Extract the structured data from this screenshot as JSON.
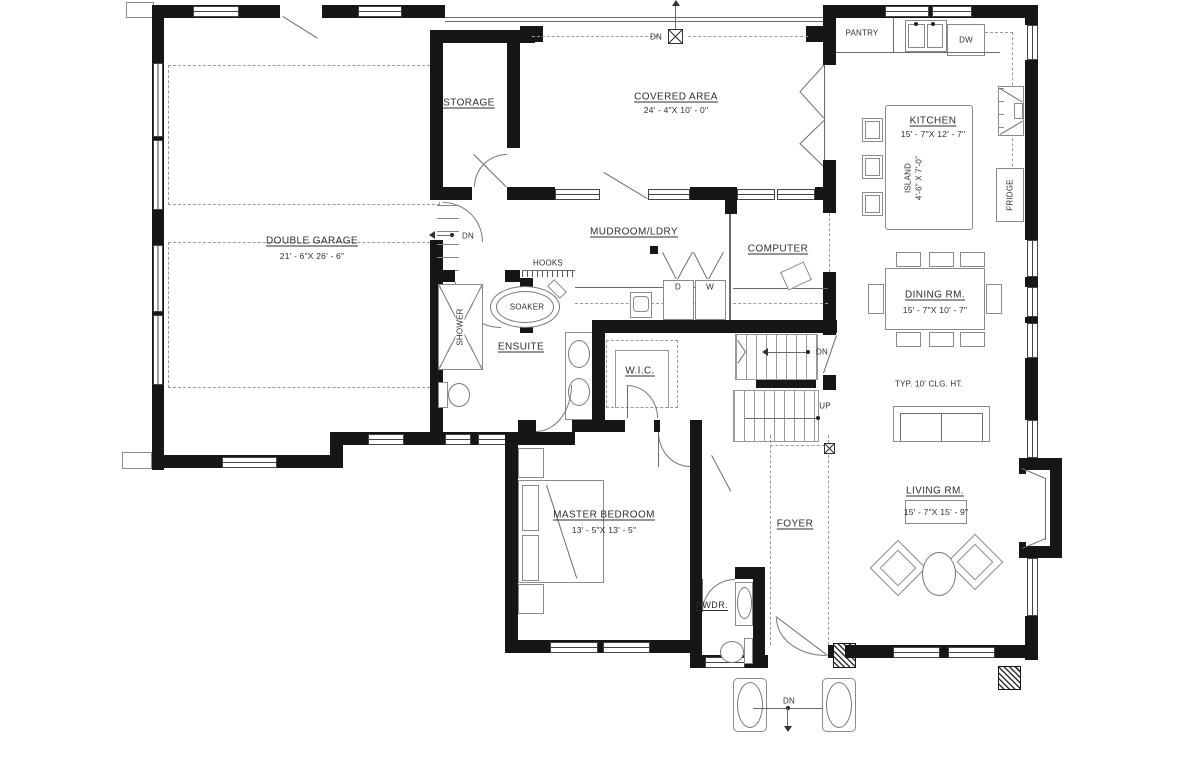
{
  "plan": {
    "rooms": {
      "double_garage": {
        "label": "DOUBLE GARAGE",
        "dims": "21' - 6\"X 26' - 6\""
      },
      "storage": {
        "label": "STORAGE"
      },
      "covered_area": {
        "label": "COVERED AREA",
        "dims": "24' - 4\"X 10' - 0\""
      },
      "pantry": {
        "label": "PANTRY"
      },
      "kitchen": {
        "label": "KITCHEN",
        "dims": "15' - 7\"X 12' - 7\""
      },
      "island": {
        "label": "ISLAND",
        "dims": "4'-6\" X 7'-0\""
      },
      "mudroom": {
        "label": "MUDROOM/LDRY"
      },
      "computer": {
        "label": "COMPUTER"
      },
      "ensuite": {
        "label": "ENSUITE"
      },
      "wic": {
        "label": "W.I.C."
      },
      "dining": {
        "label": "DINING RM.",
        "dims": "15' - 7\"X 10' - 7\""
      },
      "living": {
        "label": "LIVING RM.",
        "dims": "15' - 7\"X 15' - 9\""
      },
      "master": {
        "label": "MASTER BEDROOM",
        "dims": "13' - 5\"X 13' - 5\""
      },
      "foyer": {
        "label": "FOYER"
      },
      "pwdr": {
        "label": "PWDR."
      }
    },
    "fixtures": {
      "dw": "DW",
      "fridge": "FRIDGE",
      "soaker": "SOAKER",
      "shower": "SHOWER",
      "hooks": "HOOKS",
      "dryer": "D",
      "washer": "W"
    },
    "annotations": {
      "ceiling": "TYP. 10' CLG. HT.",
      "up": "UP",
      "dn": "DN"
    }
  }
}
